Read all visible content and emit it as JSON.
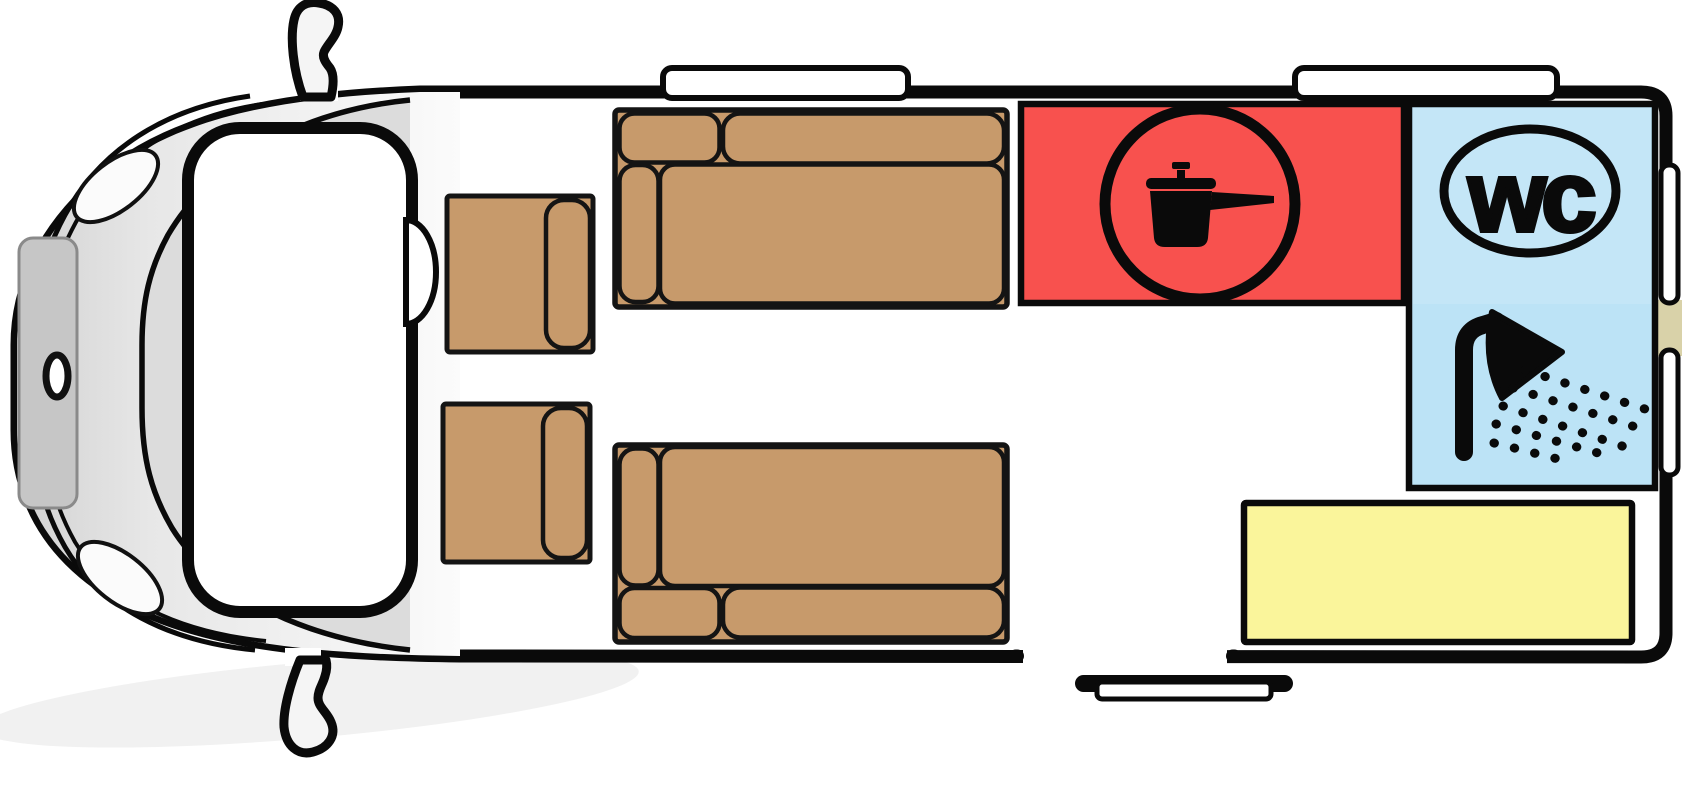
{
  "meta": {
    "diagram_type": "campervan-floorplan"
  },
  "labels": {
    "wc_badge": "wc"
  },
  "colors": {
    "outline": "#0a0a0a",
    "kitchen_red": "#F8514E",
    "bath_blue": "#BCE3F6",
    "bench_yellow": "#FAF59B",
    "upholstery_brown": "#C79A6B",
    "trim_tan": "#D9D2A9",
    "windshield_gray": "#DCDCDC",
    "door_panel_gray": "#C6C6C6",
    "shadow_gray": "#F1F1F1"
  },
  "icons": {
    "kitchen": "cooking-pot-icon",
    "toilet": "wc-badge-icon",
    "shower": "shower-icon"
  },
  "zones": {
    "cab": "driver-cab",
    "seat_upper": "swivel-seat-upper",
    "seat_lower": "swivel-seat-lower",
    "sofa_upper": "lounge-sofa-upper",
    "sofa_lower": "lounge-sofa-lower",
    "kitchen": "kitchen-block",
    "bathroom": "wc-shower-cabin",
    "rear_bench": "rear-bench"
  }
}
